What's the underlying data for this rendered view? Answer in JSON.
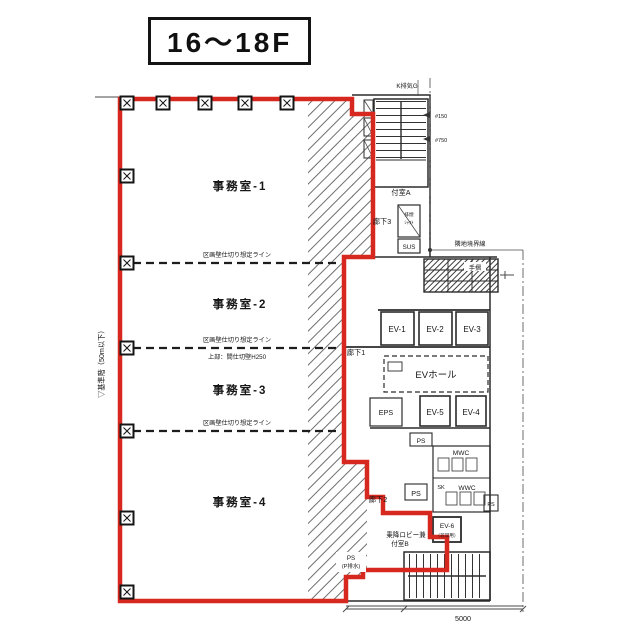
{
  "title": "16～18F",
  "plan": {
    "offices": [
      {
        "label": "事務室-1"
      },
      {
        "label": "事務室-2"
      },
      {
        "label": "事務室-3"
      },
      {
        "label": "事務室-4"
      }
    ],
    "partition": {
      "label": "区画壁仕切り想定ライン",
      "sub": "上部：間仕切壁H250"
    },
    "notes": {
      "left_vertical": "▽基準階（50m以下）",
      "top": "K排気G",
      "level1": "#150",
      "level2": "#750",
      "boundary": "隣地境界線",
      "handrail": "手摺",
      "dim": "5000"
    },
    "rooms": {
      "stair_a": "付室A",
      "corridor3": "廊下3",
      "smoke1": "排煙",
      "smoke2": "ｼｬﾌﾄ",
      "sus": "SUS",
      "corridor1": "廊下1",
      "ev1": "EV-1",
      "ev2": "EV-2",
      "ev3": "EV-3",
      "ev_hall": "EVホール",
      "eps": "EPS",
      "ev5": "EV-5",
      "ev4": "EV-4",
      "ps_a": "PS",
      "ps_b": "PS",
      "ps_c": "PS",
      "mwc": "MWC",
      "sk": "SK",
      "wwc": "WWC",
      "corridor2": "廊下2",
      "lobby1": "乗降ロビー兼",
      "lobby2": "付室B",
      "ev6": "EV-6",
      "ev6_sub": "（非常用）",
      "ps_d1": "PS",
      "ps_d2": "(P排水)"
    },
    "colors": {
      "lease_line": "#d7281f",
      "plan_line": "#2b2b2b"
    }
  }
}
